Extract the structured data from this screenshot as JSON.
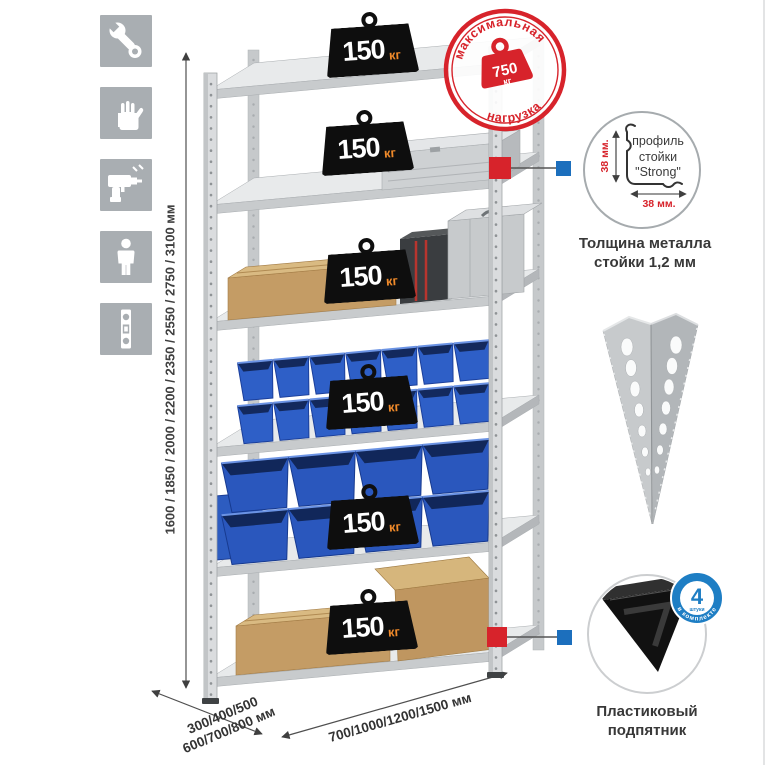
{
  "icons": {
    "items": [
      {
        "name": "wrench"
      },
      {
        "name": "gloves"
      },
      {
        "name": "drill"
      },
      {
        "name": "person"
      },
      {
        "name": "level"
      }
    ]
  },
  "dimensions": {
    "height": "1600 / 1850 / 2000 / 2200 / 2350 / 2550 / 2750 / 3100 мм",
    "depth_line1": "300/400/500",
    "depth_line2": "600/700/800 мм",
    "width": "700/1000/1200/1500 мм"
  },
  "weights": [
    {
      "value": "150",
      "unit": "кг"
    },
    {
      "value": "150",
      "unit": "кг"
    },
    {
      "value": "150",
      "unit": "кг"
    },
    {
      "value": "150",
      "unit": "кг"
    },
    {
      "value": "150",
      "unit": "кг"
    },
    {
      "value": "150",
      "unit": "кг"
    }
  ],
  "stamp": {
    "arc_top": "максимальная",
    "arc_bottom": "нагрузка",
    "value": "750",
    "unit": "кг",
    "color": "#d7232b"
  },
  "profile_detail": {
    "line1": "профиль",
    "line2": "стойки",
    "line3": "\"Strong\"",
    "dim_side": "38 мм.",
    "dim_bottom": "38 мм.",
    "caption1": "Толщина металла",
    "caption2": "стойки 1,2 мм"
  },
  "foot_detail": {
    "badge_number": "4",
    "badge_unit": "штуки",
    "badge_arc": "в комплекте",
    "badge_color": "#1e7ec4",
    "caption1": "Пластиковый",
    "caption2": "подпятник"
  },
  "colors": {
    "accent_red": "#d7232b",
    "accent_blue": "#1c6fbd",
    "bin_blue": "#2e5fc7",
    "metal_gray": "#d8dadc",
    "icon_gray": "#a9aeb2"
  }
}
